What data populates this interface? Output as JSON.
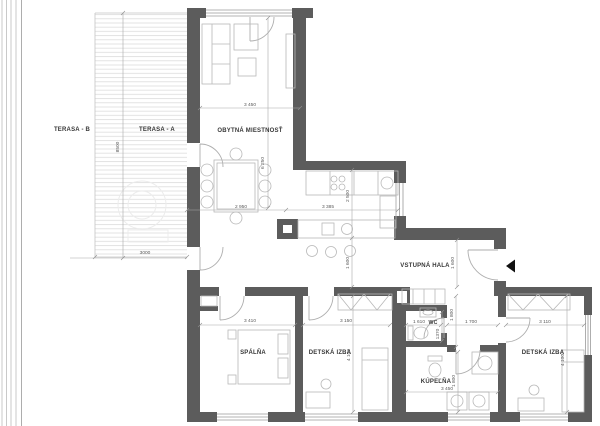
{
  "plan": {
    "rooms": {
      "terasa_b": "TERASA - B",
      "terasa_a": "TERASA - A",
      "obytna_miestnost": "OBYTNÁ MIESTNOSŤ",
      "vstupna_hala": "VSTUPNÁ HALA",
      "spalna": "SPÁLŇA",
      "detska_izba_1": "DETSKÁ IZBA",
      "wc": "WC",
      "kupelna": "KÚPEĽŇA",
      "detska_izba_2": "DETSKÁ IZBA"
    },
    "dimensions": {
      "living_width": "3 450",
      "living_depth": "6 250",
      "dining_width": "2 950",
      "kitchen_width": "3 385",
      "kitchen_depth": "2 500",
      "hall_left_height": "1 600",
      "hall_right_height": "1 600",
      "terrace_depth": "8500",
      "terrace_width": "3000",
      "spalna_width": "3 410",
      "detska1_width": "3 150",
      "detska1_depth": "4 100",
      "wc_width": "1 610",
      "wc_depth": "1370",
      "wc_height": "1 800",
      "corridor_width": "1 700",
      "kupelna_width": "3 450",
      "kupelna_depth": "1 800",
      "detska2_width": "3 110",
      "detska2_depth": "4 100"
    },
    "colors": {
      "wall": "#5c5c5c",
      "thin_line": "#b5b5b5",
      "dim_line": "#9a9a9a"
    }
  }
}
